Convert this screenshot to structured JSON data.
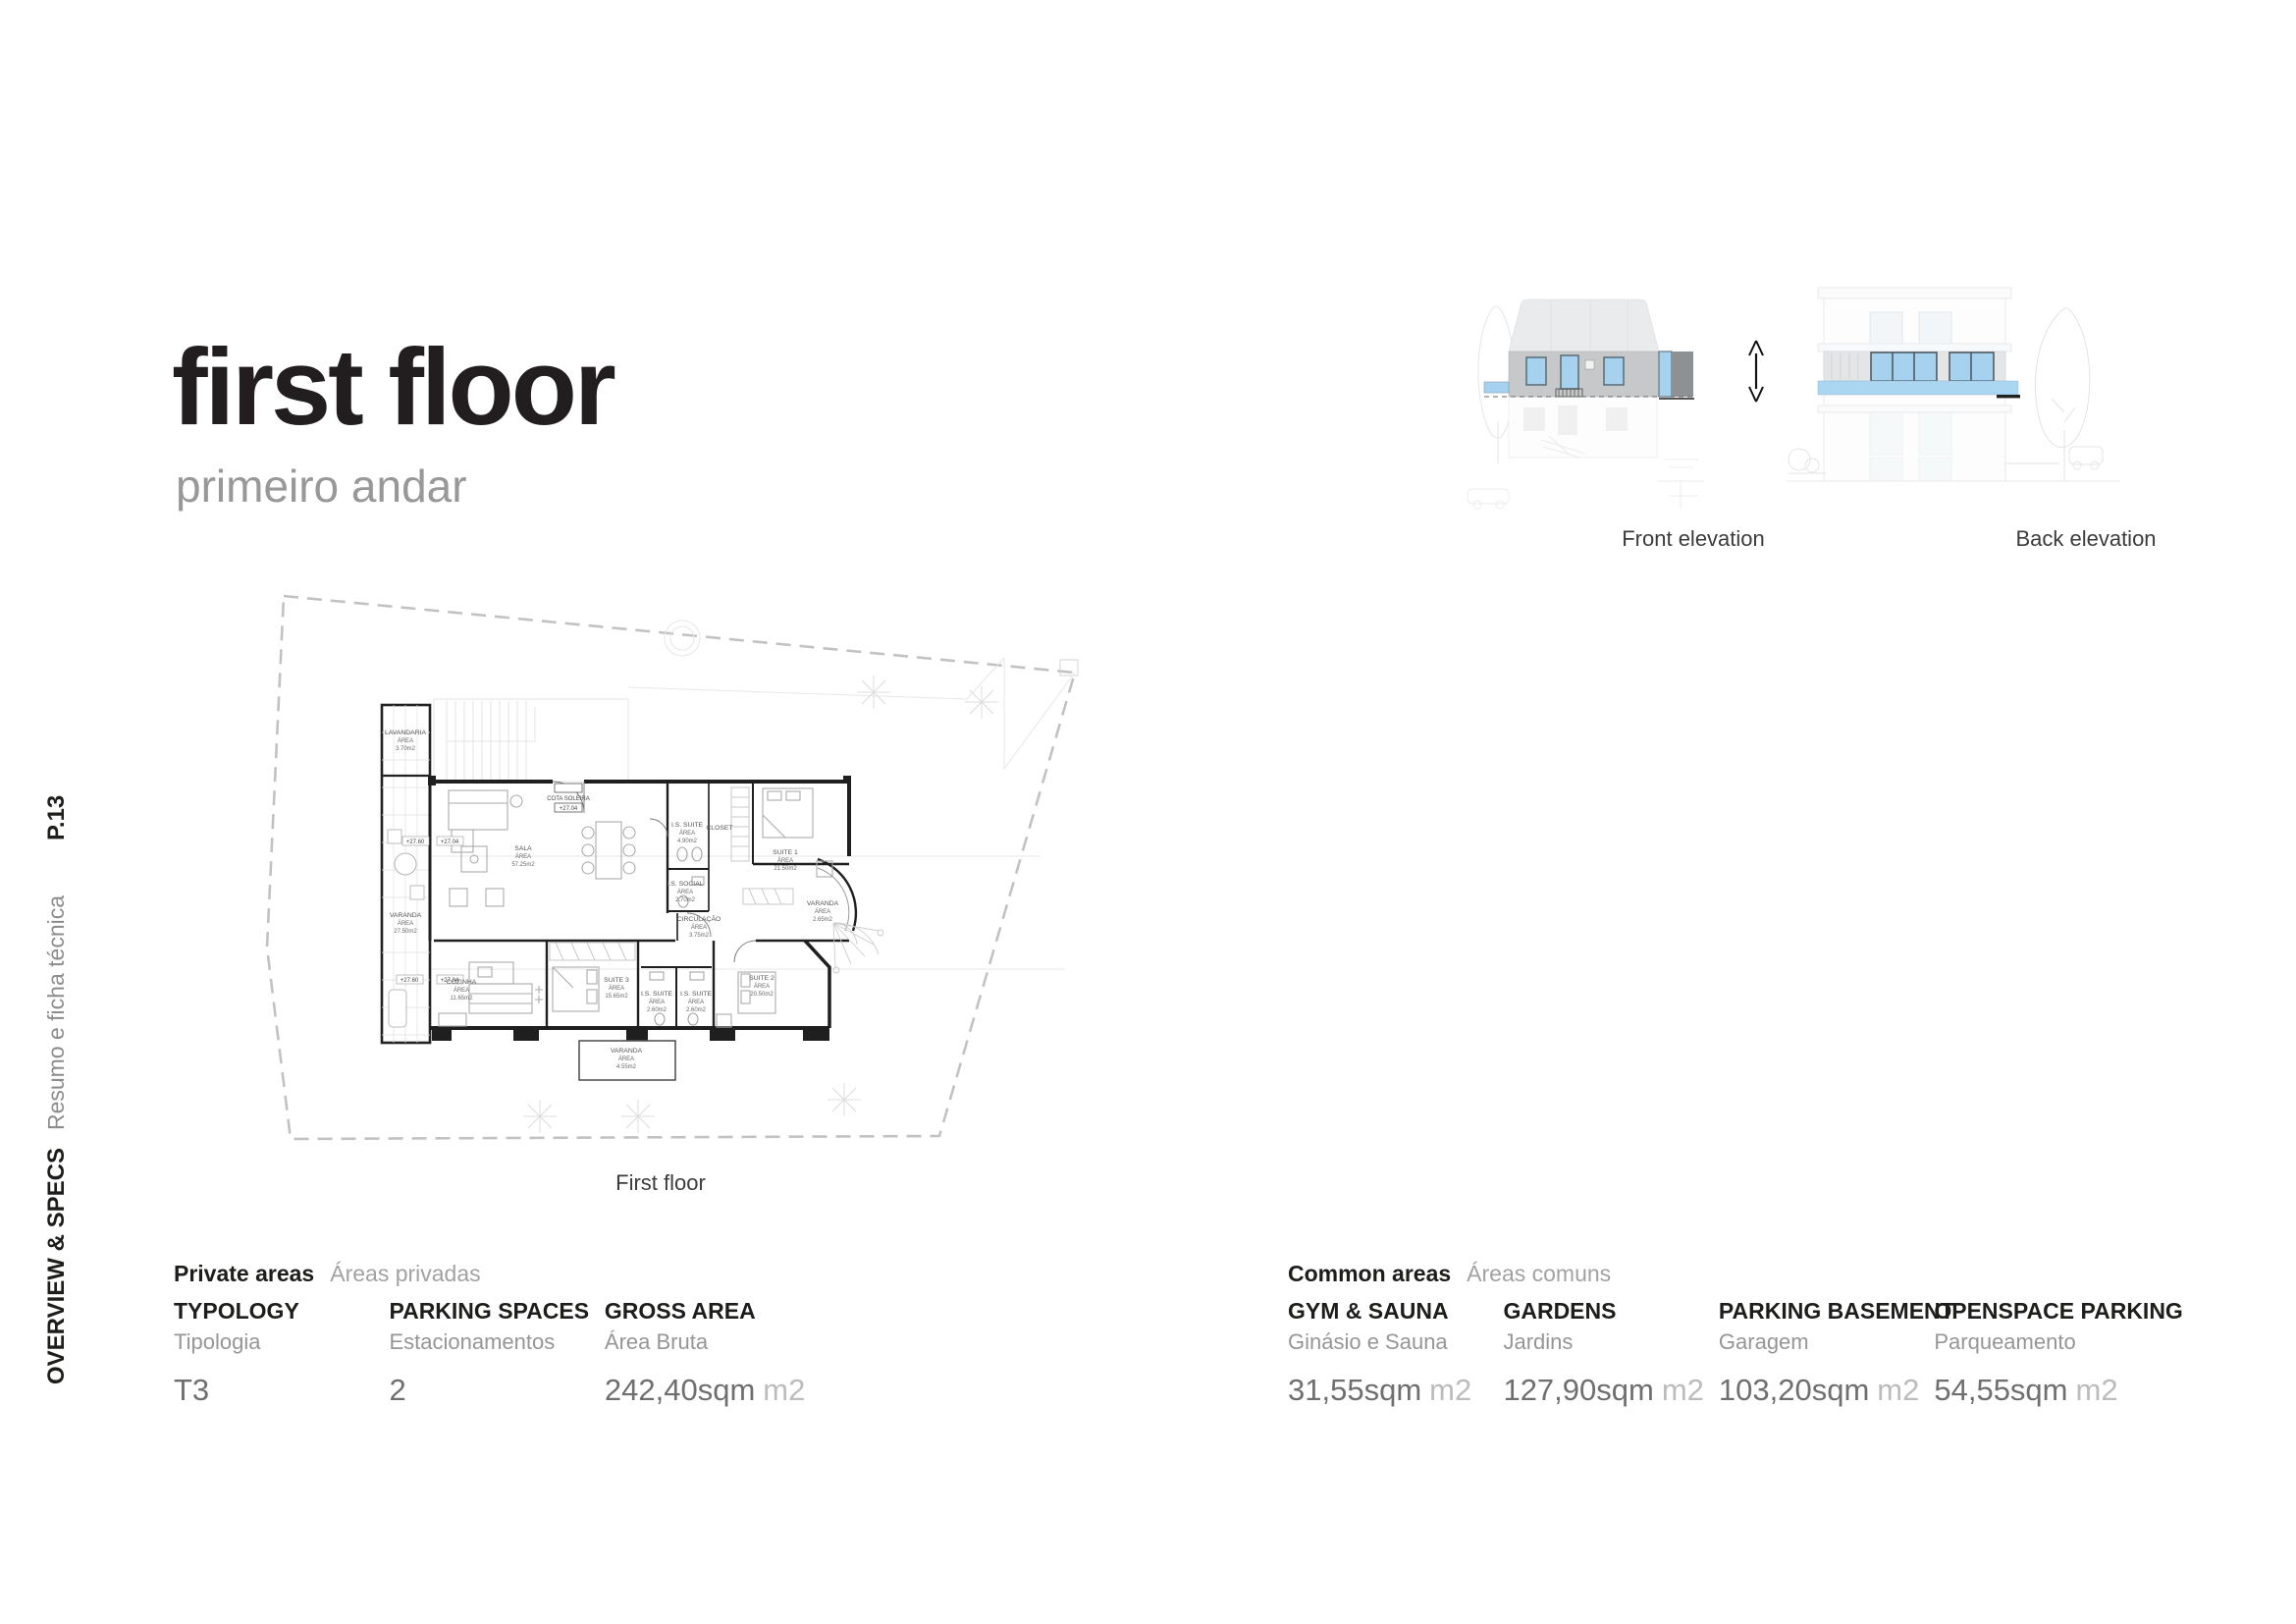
{
  "page": {
    "title": "first floor",
    "subtitle": "primeiro andar",
    "page_number": "P.13",
    "section_label_en": "OVERVIEW & SPECS",
    "section_label_pt": "Resumo e ficha técnica"
  },
  "plan": {
    "caption": "First floor",
    "area_word": "ÁREA",
    "threshold_label": "COTA SOLEIRA",
    "levels": {
      "upper": "+27.60",
      "entry": "+27.04"
    },
    "rooms": [
      {
        "name": "LAVANDARIA",
        "area": "3.70m2"
      },
      {
        "name": "VARANDA",
        "area": "27.50m2"
      },
      {
        "name": "SALA",
        "area": "57.25m2"
      },
      {
        "name": "I.S. SUITE",
        "area": "4.90m2"
      },
      {
        "name": "CLOSET",
        "area": ""
      },
      {
        "name": "SUITE 1",
        "area": "21.50m2"
      },
      {
        "name": "I.S. SOCIAL",
        "area": "2.70m2"
      },
      {
        "name": "CIRCULAÇÃO",
        "area": "3.75m2"
      },
      {
        "name": "VARANDA",
        "area": "2.65m2"
      },
      {
        "name": "COZINHA",
        "area": "11.65m2"
      },
      {
        "name": "SUITE 3",
        "area": "15.65m2"
      },
      {
        "name": "I.S. SUITE",
        "area": "2.60m2"
      },
      {
        "name": "I.S. SUITE",
        "area": "2.60m2"
      },
      {
        "name": "SUITE 2",
        "area": "20.50m2"
      },
      {
        "name": "VARANDA",
        "area": "4.55m2"
      }
    ]
  },
  "elevations": {
    "front_label": "Front elevation",
    "back_label": "Back elevation"
  },
  "private_areas": {
    "header_en": "Private areas",
    "header_pt": "Áreas privadas",
    "items": [
      {
        "label_en": "TYPOLOGY",
        "label_pt": "Tipologia",
        "value": "T3",
        "unit": ""
      },
      {
        "label_en": "PARKING SPACES",
        "label_pt": "Estacionamentos",
        "value": "2",
        "unit": ""
      },
      {
        "label_en": "GROSS AREA",
        "label_pt": "Área Bruta",
        "value": "242,40sqm",
        "unit": "m2"
      }
    ]
  },
  "common_areas": {
    "header_en": "Common areas",
    "header_pt": "Áreas comuns",
    "items": [
      {
        "label_en": "GYM & SAUNA",
        "label_pt": "Ginásio e Sauna",
        "value": "31,55sqm",
        "unit": "m2"
      },
      {
        "label_en": "GARDENS",
        "label_pt": "Jardins",
        "value": "127,90sqm",
        "unit": "m2"
      },
      {
        "label_en": "PARKING BASEMENT",
        "label_pt": "Garagem",
        "value": "103,20sqm",
        "unit": "m2"
      },
      {
        "label_en": "OPENSPACE PARKING",
        "label_pt": "Parqueamento",
        "value": "54,55sqm",
        "unit": "m2"
      }
    ]
  },
  "colors": {
    "highlight_blue": "#a6d2ef",
    "slab_blue": "#abd6f2",
    "elevation_wall_gray": "#c6c8c9",
    "elevation_dark_gray": "#8e9193",
    "title_black": "#221e1f",
    "muted_gray": "#98989a",
    "value_gray": "#6f6f6f",
    "unit_gray": "#bcbcbc"
  }
}
